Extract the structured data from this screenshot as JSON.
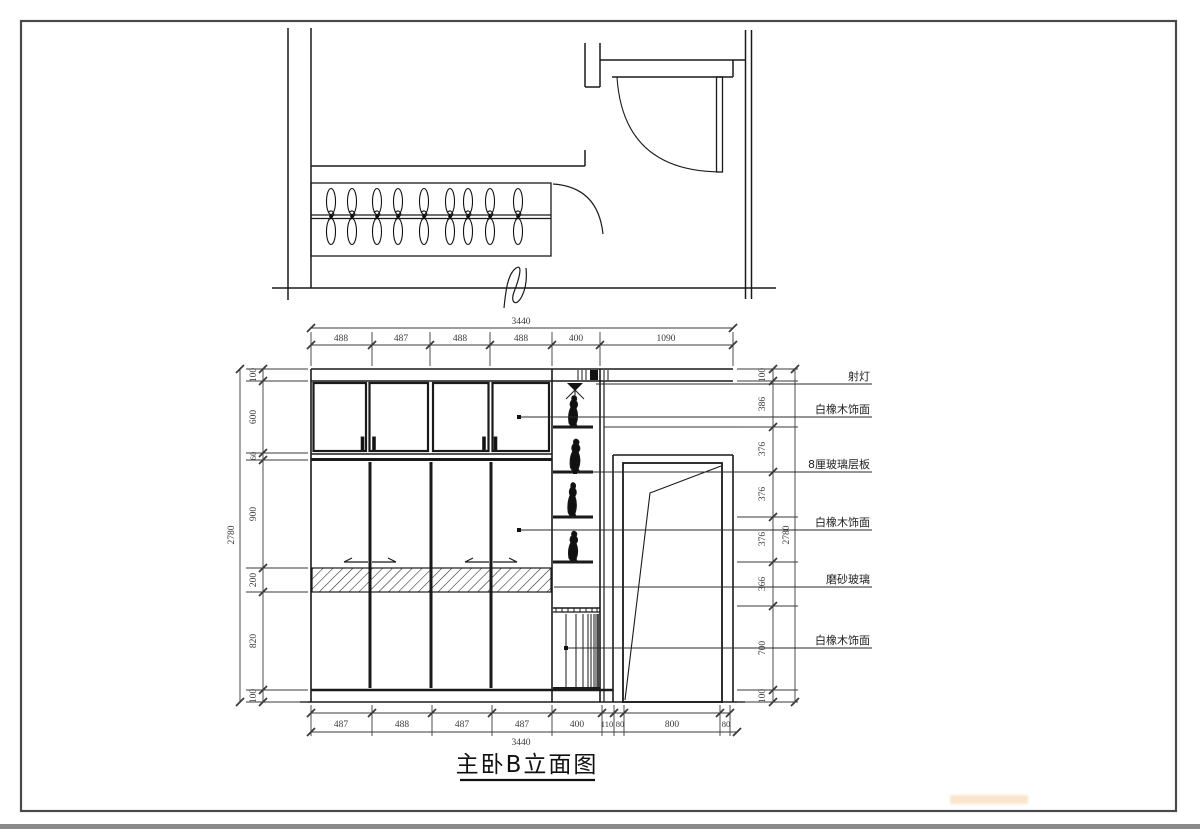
{
  "title": {
    "text": "主卧B立面图"
  },
  "callouts": {
    "items": [
      "射灯",
      "白橡木饰面",
      "8厘玻璃层板",
      "白橡木饰面",
      "磨砂玻璃",
      "白橡木饰面"
    ]
  },
  "dims": {
    "top": {
      "total": "3440",
      "segments": [
        "488",
        "487",
        "488",
        "488",
        "400",
        "1090"
      ]
    },
    "bottom": {
      "total": "3440",
      "segments": [
        "487",
        "488",
        "487",
        "487",
        "400",
        "110",
        "80",
        "800",
        "80"
      ]
    },
    "left": {
      "total": "2780",
      "segments": [
        "100",
        "600",
        "60",
        "900",
        "200",
        "820",
        "100"
      ]
    },
    "right": {
      "total": "2780",
      "segments": [
        "100",
        "386",
        "376",
        "376",
        "376",
        "366",
        "700",
        "100"
      ]
    }
  },
  "colors": {
    "line": "#1a1a1a",
    "dimension": "#3a3a3a",
    "page_border": "#4a4a4a",
    "watermark": "#ebaa55"
  }
}
